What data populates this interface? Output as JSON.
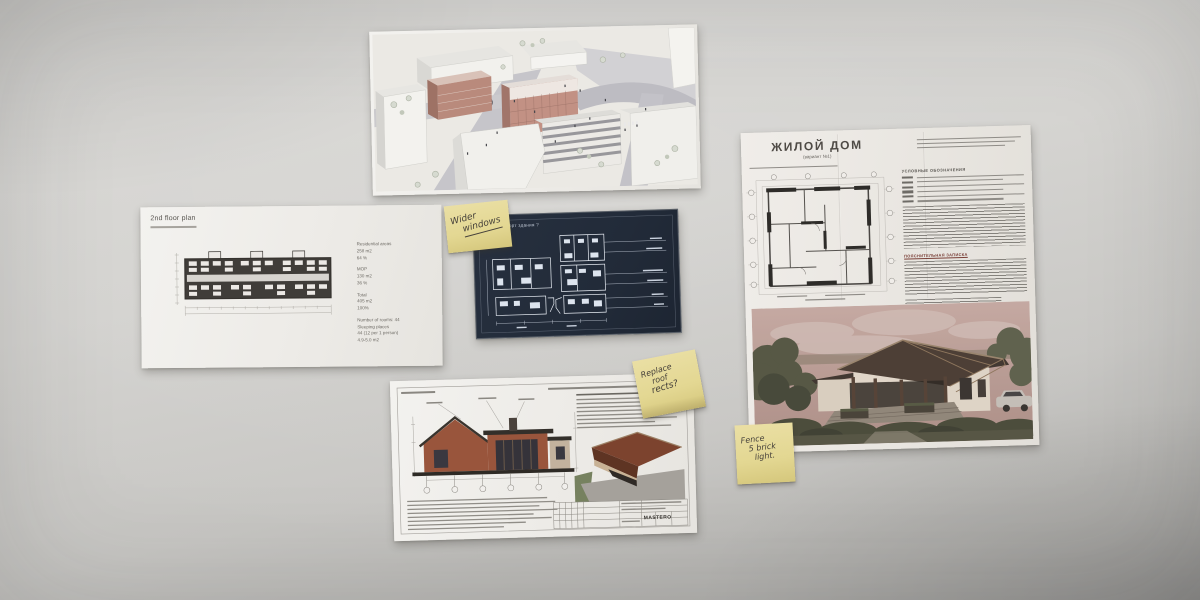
{
  "wall": {
    "base_color": "#d3d2cf",
    "vignette_color": "#a3a2a0"
  },
  "floor_plan_sheet": {
    "title": "2nd floor plan",
    "stats_groups": [
      {
        "lines": [
          "Residential areas",
          "258 m2",
          "64 %"
        ]
      },
      {
        "lines": [
          "MOP",
          "130 m2",
          "36 %"
        ]
      },
      {
        "lines": [
          "Total",
          "405 m2",
          "100%"
        ]
      },
      {
        "lines": [
          "Number of rooms: 44",
          "Sleeping places",
          "44 (12 per 1 person)",
          "4.9-5.0 m2"
        ]
      }
    ]
  },
  "blueprint_sheet": {
    "title": "как комфорт здания ?",
    "background_color": "#222b39",
    "line_color": "#e8edf4"
  },
  "elevation_sheet": {
    "stamp_logo": "MASTERO",
    "house_wall_color": "#99553c",
    "roof_color": "#332f2a"
  },
  "russian_doc": {
    "title": "ЖИЛОЙ ДОМ",
    "subtitle": "(вариант №1)",
    "legend_heading": "УСЛОВНЫЕ ОБОЗНАЧЕНИЯ",
    "notes_heading": "ПОЯСНИТЕЛЬНАЯ ЗАПИСКА",
    "photo_sky_color": "#c0a39d"
  },
  "sticky_notes": {
    "note_windows": {
      "lines": [
        "Wider",
        "windows"
      ],
      "paper_color": "#e3d792"
    },
    "note_roof": {
      "lines": [
        "Replace",
        "roof",
        "rects?"
      ],
      "paper_color": "#e3d792"
    },
    "note_brick": {
      "lines": [
        "Fence",
        "5 brick",
        "light."
      ],
      "paper_color": "#e3d792"
    }
  }
}
